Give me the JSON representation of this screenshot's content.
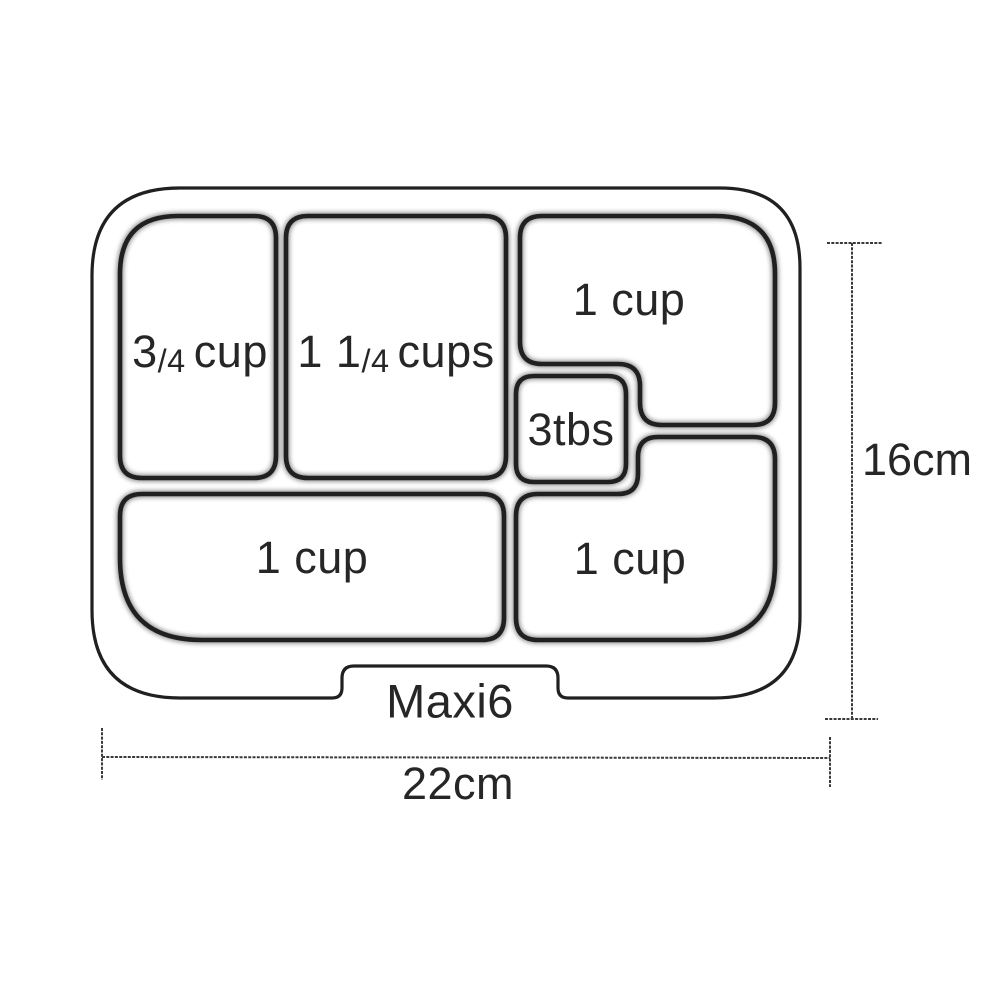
{
  "diagram": {
    "product_label": "Maxi6",
    "height_dimension": "16cm",
    "width_dimension": "22cm"
  },
  "compartments": [
    {
      "name": "top-left",
      "whole": "3",
      "frac": "/4",
      "unit": "cup"
    },
    {
      "name": "top-middle",
      "whole": "1 1",
      "frac": "/4",
      "unit": "cups"
    },
    {
      "name": "top-right",
      "label": "1 cup"
    },
    {
      "name": "middle-small",
      "label": "3tbs"
    },
    {
      "name": "bottom-left",
      "label": "1 cup"
    },
    {
      "name": "bottom-right",
      "label": "1 cup"
    }
  ],
  "colors": {
    "line": "#202020",
    "dimension_line": "#3a3a3a",
    "text": "#262626",
    "background": "#ffffff"
  }
}
